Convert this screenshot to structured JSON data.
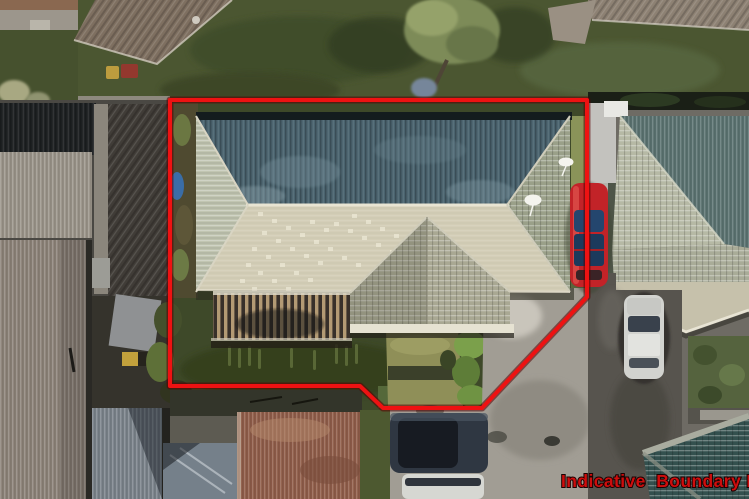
{
  "overlay": {
    "label": "Indicative  Boundary Line",
    "label_color": "#cf0d0d",
    "line_color": "#ee1212",
    "line_underlay_color": "#5a0000",
    "boundary_points": "170,100 587,100 587,297 482,408 383,408 360,386 170,386"
  },
  "scene": {
    "description": "Aerial drone photo of a hip-roof house inside a red indicative boundary, with neighbouring roofs, sheds, lawns, driveways and parked cars",
    "property": {
      "roof_shaded_color": "#4a636e",
      "roof_sunlit_color": "#d3cdb6",
      "lawn_color": "#3e4929",
      "driveway_color": "#a19d94"
    },
    "vehicles": [
      {
        "name": "red-car",
        "color": "#c22328"
      },
      {
        "name": "silver-car",
        "color": "#d2d3cf"
      },
      {
        "name": "navy-car",
        "color": "#2f3742"
      },
      {
        "name": "white-car",
        "color": "#d6d7d2"
      }
    ]
  }
}
